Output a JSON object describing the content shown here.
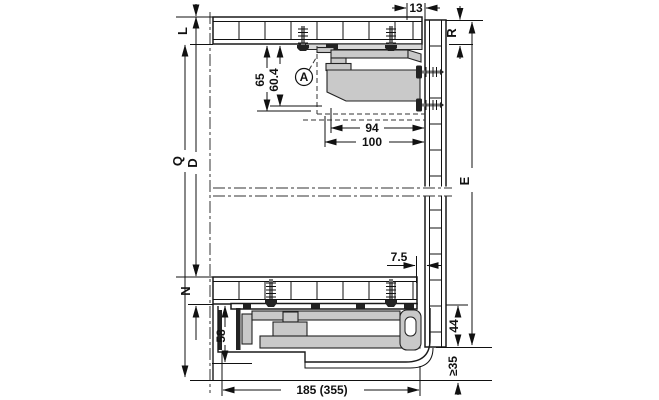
{
  "drawing": {
    "top": {
      "panel_thickness": "L",
      "rear_gap": "13",
      "back_offset": "R",
      "height_a": "65",
      "height_b": "60.4",
      "detail": "A",
      "depth_a": "94",
      "depth_b": "100"
    },
    "middle": {
      "outer_height": "Q",
      "inner_height": "D",
      "back_height": "E"
    },
    "bottom": {
      "panel_thickness": "N",
      "rear_gap": "7.5",
      "runner_height": "58",
      "back_bottom": "44",
      "clearance": "≥35",
      "runner_length": "185 (355)"
    }
  }
}
